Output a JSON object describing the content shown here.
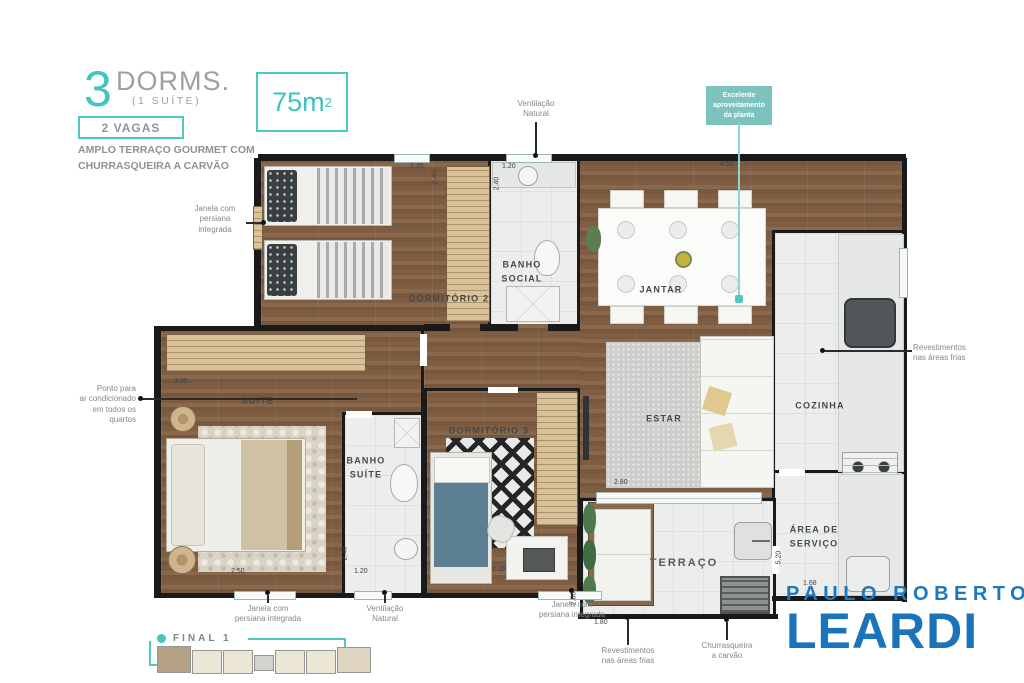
{
  "header": {
    "count": "3",
    "dorms": "DORMS.",
    "suite": "(1 SUÍTE)",
    "vagas": "2 VAGAS",
    "tagline1": "AMPLO TERRAÇO GOURMET COM",
    "tagline2": "CHURRASQUEIRA A CARVÃO"
  },
  "area_box": {
    "value": "75m",
    "exp": "2"
  },
  "callout": {
    "line1": "Excelente",
    "line2": "aproveitamento",
    "line3": "da planta"
  },
  "rooms": {
    "dorm2": "DORMITÓRIO 2",
    "banho_social": [
      "BANHO",
      "SOCIAL"
    ],
    "jantar": "JANTAR",
    "cozinha": "COZINHA",
    "estar": "ESTAR",
    "suite": "SUÍTE",
    "banho_suite": [
      "BANHO",
      "SUÍTE"
    ],
    "dorm3": "DORMITÓRIO 3",
    "servico": [
      "ÁREA DE",
      "SERVIÇO"
    ],
    "terraco": "TERRAÇO"
  },
  "annotations": {
    "vent_top": [
      "Ventilação",
      "Natural"
    ],
    "janela_left": [
      "Janela com",
      "persiana",
      "integrada"
    ],
    "ponto_ar": [
      "Ponto para",
      "ar condicionado",
      "em todos os",
      "quartos"
    ],
    "revest_right": [
      "Revestimentos",
      "nas áreas frias"
    ],
    "janela_b1": [
      "Janela com",
      "persiana integrada"
    ],
    "vent_b": [
      "Ventilação",
      "Natural"
    ],
    "janela_b2": [
      "Janela com",
      "persiana integrada"
    ],
    "revest_b": [
      "Revestimentos",
      "nas áreas frias"
    ],
    "churras_b": [
      "Churrasqueira",
      "a carvão"
    ]
  },
  "dimensions": [
    "1.35",
    "2.40",
    "1.20",
    "2.40",
    "4.10",
    "3.95",
    "2.50",
    "2.45",
    "1.20",
    "2.15",
    "2.80",
    "1.80",
    "2.80",
    "5.20",
    "1.68"
  ],
  "keyplan": {
    "label": "FINAL 1"
  },
  "logo": {
    "line1": "PAULO ROBERTO",
    "line2": "LEARDI"
  },
  "colors": {
    "teal": "#41C6BD",
    "logo_blue": "#1B75BB",
    "wood": "#7D5C42",
    "tile": "#ECEDED",
    "wall": "#1A1A1A"
  }
}
